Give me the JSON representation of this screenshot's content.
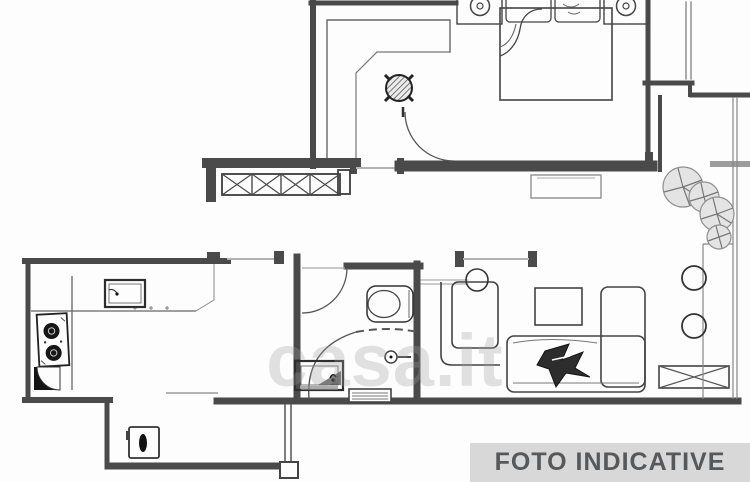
{
  "floorplan": {
    "watermark_text": "casa.it",
    "caption_label": "FOTO INDICATIVE",
    "colors": {
      "background": "#fdfdfd",
      "wall": "#4a4a4a",
      "furniture_line": "#444444",
      "light_line": "#9a9a9a",
      "open_door_line": "#b3b3b3",
      "caption_bg": "#d8d8d8",
      "caption_text": "#57585a",
      "watermark": "#9f9f9f",
      "appliance_dark": "#141414"
    },
    "elements": [
      "entry-hall",
      "hall-wardrobe",
      "ceiling-lamp",
      "bedroom",
      "double-bed",
      "nightstand-lamps",
      "pillows",
      "bedroom-door",
      "window-sill",
      "kitchen",
      "kitchen-counter",
      "kitchen-sink",
      "stove",
      "corner-unit",
      "laundry-alcove",
      "washing-machine",
      "bathroom",
      "bathroom-door",
      "toilet",
      "shower",
      "washbasin",
      "bathroom-window",
      "living-room",
      "armchair",
      "floor-lamp",
      "coffee-table",
      "sofa",
      "throw-blanket",
      "radiator-grille",
      "balcony",
      "plants",
      "stools",
      "railing"
    ]
  }
}
